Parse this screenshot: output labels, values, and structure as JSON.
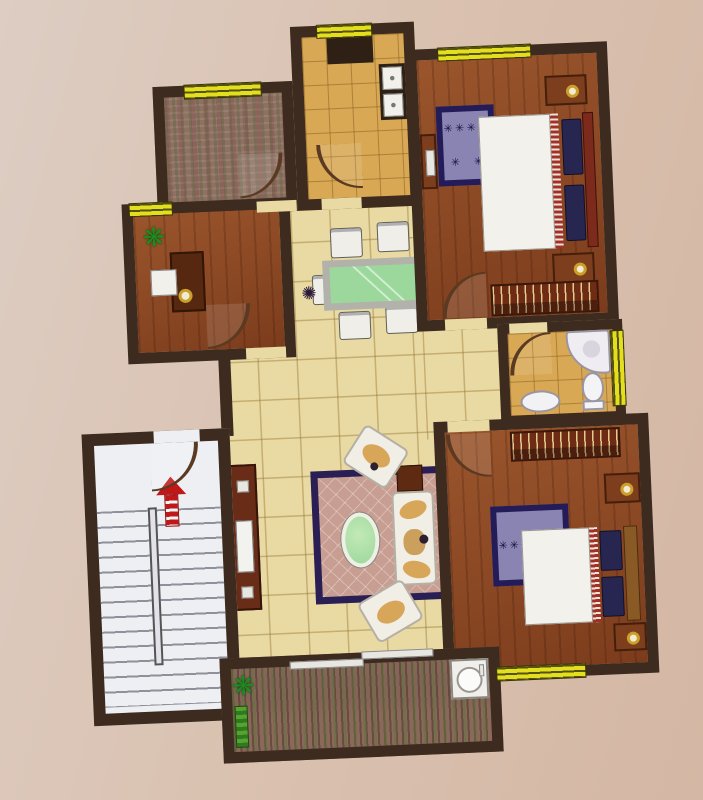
{
  "scene": {
    "description": "photographed-apartment-floor-plan",
    "text_labels": []
  },
  "palette": {
    "wall": "#3c2b1e",
    "window": "#e3df1f",
    "tile_cream": "#e9d9a3",
    "tile_tan": "#d8a855",
    "stair": "#edeff3",
    "rug_living": "#c89e93",
    "rug_border": "#2a1f55",
    "rug_bedroom": "#8a84b2",
    "glass_green": "#9cd89c",
    "arrow_red": "#c01818",
    "balcony_base": "#8a685a",
    "edge_red": "#8f2222"
  },
  "glyphs": {
    "plant": "❋",
    "rug_star": "✳",
    "dining_accent": "✺"
  },
  "stairs": {
    "visible_steps": 13,
    "direction": "up"
  },
  "rooms": [
    {
      "name": "utility-room",
      "floor": "mottled-carpet"
    },
    {
      "name": "kitchen",
      "floor": "tan-tile",
      "fixtures": [
        "double-sink",
        "stove"
      ]
    },
    {
      "name": "bedroom-1",
      "floor": "wood",
      "furniture": [
        "double-bed",
        "wardrobe",
        "nightstand",
        "nightstand",
        "star-rug",
        "dresser"
      ]
    },
    {
      "name": "study",
      "floor": "wood",
      "furniture": [
        "desk",
        "computer",
        "plant"
      ]
    },
    {
      "name": "dining-area",
      "floor": "cream-tile",
      "furniture": [
        "glass-dining-table",
        "chair",
        "chair",
        "chair",
        "chair",
        "chair"
      ]
    },
    {
      "name": "bathroom",
      "floor": "tan-tile",
      "fixtures": [
        "corner-bathtub",
        "toilet",
        "washbasin"
      ]
    },
    {
      "name": "stairwell",
      "floor": "concrete",
      "fixtures": [
        "staircase",
        "up-arrow",
        "entry-door"
      ]
    },
    {
      "name": "living-room",
      "floor": "cream-tile",
      "furniture": [
        "sofa",
        "armchair",
        "armchair",
        "oval-coffee-table",
        "rug",
        "tv-cabinet",
        "side-table"
      ]
    },
    {
      "name": "bedroom-2",
      "floor": "wood",
      "furniture": [
        "double-bed",
        "wardrobe",
        "nightstand",
        "nightstand",
        "star-rug"
      ]
    },
    {
      "name": "balcony",
      "floor": "striped-decking",
      "fixtures": [
        "washing-machine",
        "plant",
        "sliding-door"
      ]
    }
  ]
}
